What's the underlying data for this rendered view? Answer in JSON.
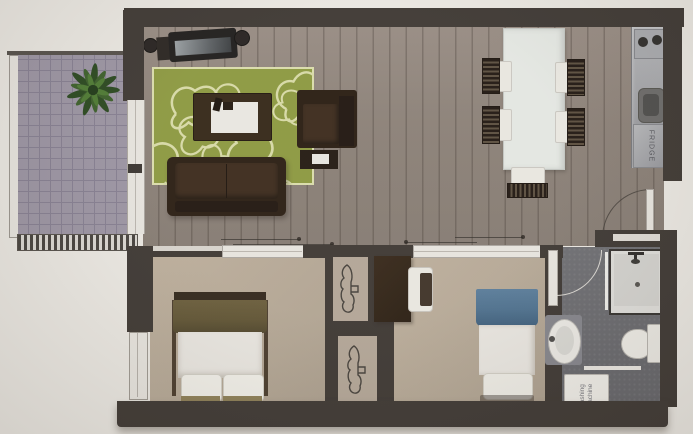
{
  "labels": {
    "fridge": "FRIDGE",
    "washing_machine": "washing machine"
  },
  "rooms": [
    "balcony",
    "living-room",
    "kitchen-dining",
    "bedroom-1",
    "bedroom-2",
    "wardrobe-nooks",
    "bathroom"
  ],
  "palette": {
    "background": "#eae7e1",
    "wall": "#3e3833",
    "wood": "#8f837a",
    "carpet": "#b8aa97",
    "balcony_tile": "#9b94a2",
    "bath_floor": "#69696d",
    "rug": "#8c9840",
    "rug_pattern": "#d6d9a6",
    "furn_dark": "#2b1e13",
    "table_white": "#e3e6e1",
    "olive": "#605434",
    "khaki": "#8d7f57",
    "blue": "#4e708d",
    "steel_light": "#b6b7ba",
    "fixture_white": "#e7e4de"
  }
}
